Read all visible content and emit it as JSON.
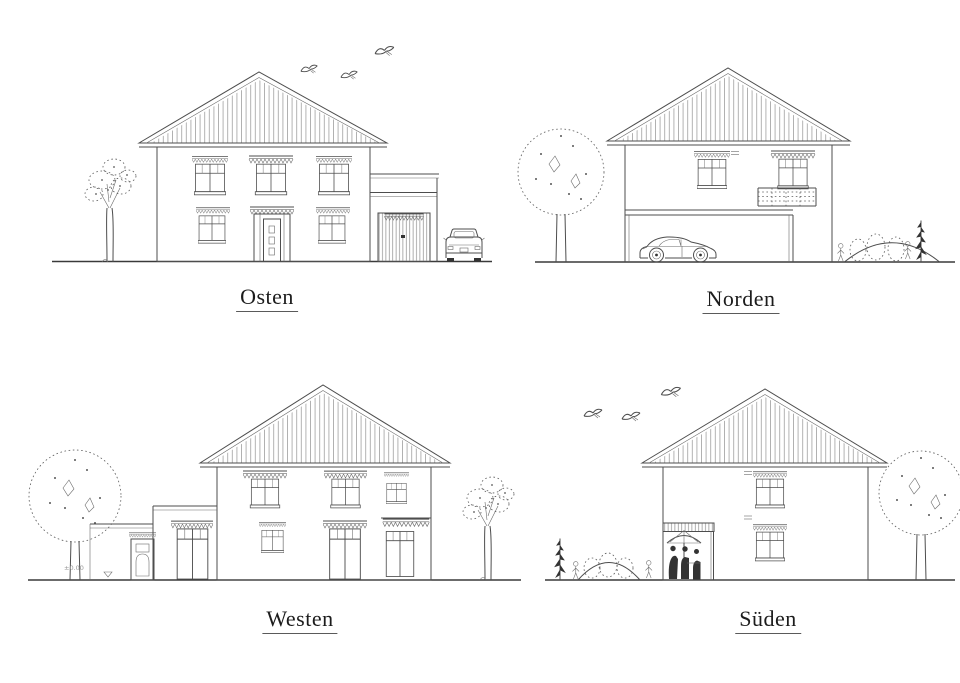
{
  "sheet": {
    "background": "#ffffff",
    "line_color": "#4d4d4d"
  },
  "views": [
    {
      "id": "osten",
      "label": "Osten"
    },
    {
      "id": "norden",
      "label": "Norden"
    },
    {
      "id": "westen",
      "label": "Westen",
      "annotation": "±0.00"
    },
    {
      "id": "sueden",
      "label": "Süden"
    }
  ]
}
